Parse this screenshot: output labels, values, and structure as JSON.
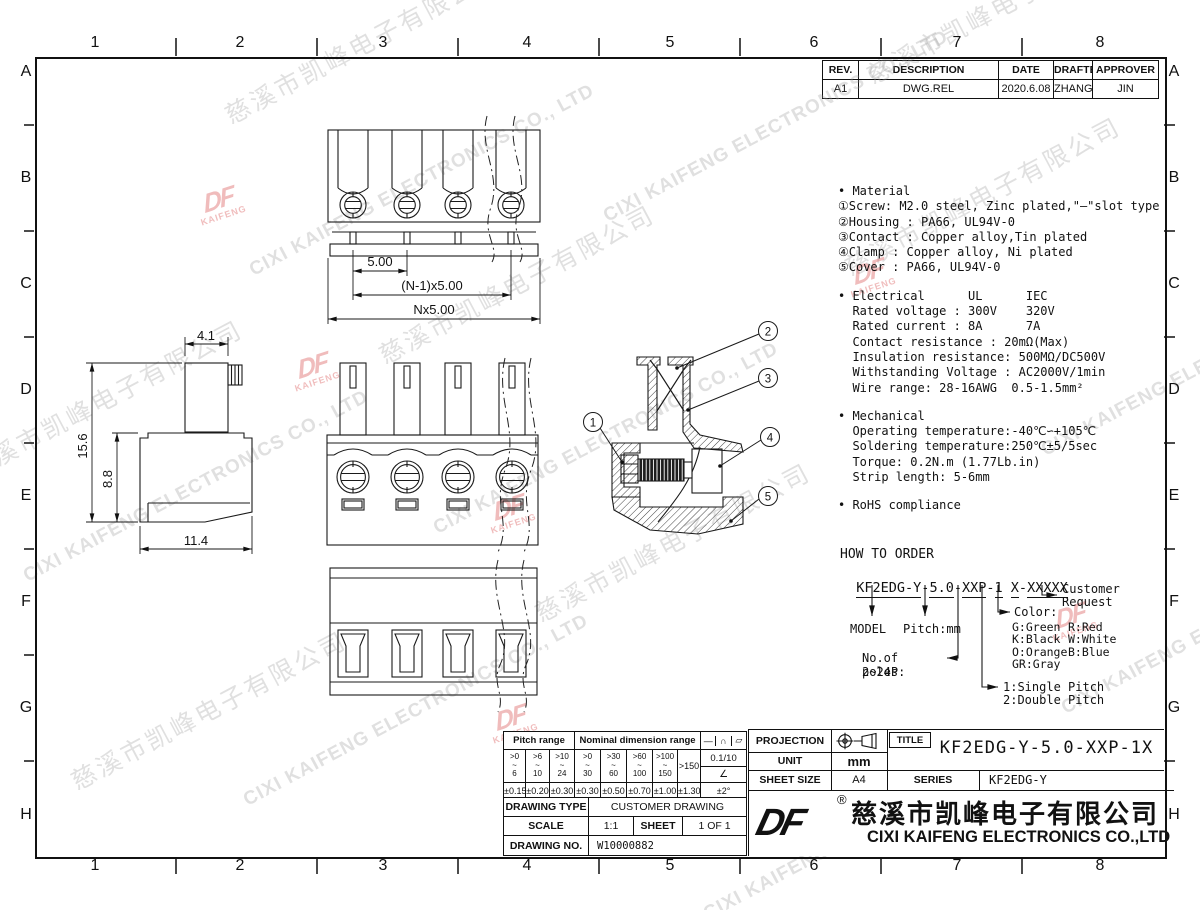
{
  "watermark": {
    "zh": "慈溪市凯峰电子有限公司",
    "en": "CIXI KAIFENG ELECTRONICS CO., LTD",
    "df": "DF",
    "kaifeng": "KAIFENG"
  },
  "grid": {
    "cols": [
      "1",
      "2",
      "3",
      "4",
      "5",
      "6",
      "7",
      "8"
    ],
    "rows": [
      "A",
      "B",
      "C",
      "D",
      "E",
      "F",
      "G",
      "H"
    ]
  },
  "revision": {
    "headers": [
      "REV.",
      "DESCRIPTION",
      "DATE",
      "DRAFTER",
      "APPROVER"
    ],
    "row": [
      "A1",
      "DWG.REL",
      "2020.6.08",
      "ZHANG",
      "JIN"
    ]
  },
  "specs": {
    "material": [
      "• Material",
      "①Screw: M2.0 steel, Zinc plated,\"—\"slot type",
      "②Housing : PA66, UL94V-0",
      "③Contact : Copper alloy,Tin plated",
      "④Clamp : Copper alloy, Ni plated",
      "⑤Cover : PA66, UL94V-0"
    ],
    "electrical": [
      "• Electrical      UL      IEC",
      "  Rated voltage : 300V    320V",
      "  Rated current : 8A      7A",
      "  Contact resistance : 20mΩ(Max)",
      "  Insulation resistance: 500MΩ/DC500V",
      "  Withstanding Voltage : AC2000V/1min",
      "  Wire range: 28-16AWG  0.5-1.5mm²"
    ],
    "mechanical": [
      "• Mechanical",
      "  Operating temperature:-40℃∽+105℃",
      "  Soldering temperature:250℃±5/5sec",
      "  Torque: 0.2N.m (1.77Lb.in)",
      "  Strip length: 5-6mm"
    ],
    "rohs": "• RoHS compliance"
  },
  "order": {
    "title": "HOW TO ORDER",
    "seg": [
      "KF2EDG-Y",
      "5.0",
      "XXP",
      "1",
      "X",
      "XXXXX"
    ],
    "dash": "-",
    "space": " ",
    "model": "MODEL",
    "pitch": "Pitch:mm",
    "poles_label": "No.of poles:",
    "poles_range": "2~24P",
    "pitch1": "1:Single Pitch",
    "pitch2": "2:Double Pitch",
    "color_title": "Color:",
    "colors_left": [
      "G:Green",
      "K:Black",
      "O:Orange",
      "GR:Gray"
    ],
    "colors_right": [
      "R:Red",
      "W:White",
      "B:Blue",
      ""
    ],
    "customer1": "Customer",
    "customer2": "Request"
  },
  "dims": {
    "pitch": "5.00",
    "pitch_n1": "(N-1)x5.00",
    "pitch_n": "Nx5.00",
    "w_top": "4.1",
    "h_total": "15.6",
    "h_body": "8.8",
    "w_bottom": "11.4"
  },
  "callouts": [
    "1",
    "2",
    "3",
    "4",
    "5"
  ],
  "tol": {
    "pitch_header": "Pitch range",
    "nominal_header": "Nominal dimension range",
    "symbols": [
      "—",
      "∩",
      "▱"
    ],
    "ranges": [
      [
        ">0",
        "~",
        "6"
      ],
      [
        ">6",
        "~",
        "10"
      ],
      [
        ">10",
        "~",
        "24"
      ],
      [
        ">0",
        "~",
        "30"
      ],
      [
        ">30",
        "~",
        "60"
      ],
      [
        ">60",
        "~",
        "100"
      ],
      [
        ">100",
        "~",
        "150"
      ]
    ],
    "range_max": ">150",
    "ratio": "0.1/10",
    "angle_symbol": "∠",
    "values": [
      "±0.15",
      "±0.20",
      "±0.30",
      "±0.30",
      "±0.50",
      "±0.70",
      "±1.00",
      "±1.30"
    ],
    "angle_value": "±2°"
  },
  "titleblock": {
    "projection": "PROJECTION",
    "unit": "UNIT",
    "unit_value": "mm",
    "sheet_size": "SHEET SIZE",
    "sheet_size_value": "A4",
    "title_label": "TITLE",
    "title_value": "KF2EDG-Y-5.0-XXP-1X",
    "series_label": "SERIES",
    "series_value": "KF2EDG-Y",
    "drawing_type": "DRAWING TYPE",
    "drawing_type_value": "CUSTOMER DRAWING",
    "scale": "SCALE",
    "scale_value": "1:1",
    "sheet": "SHEET",
    "sheet_value": "1 OF 1",
    "drawing_no": "DRAWING NO.",
    "drawing_no_value": "W10000882",
    "company_zh": "慈溪市凯峰电子有限公司",
    "company_en": "CIXI KAIFENG ELECTRONICS CO.,LTD",
    "registered": "®",
    "logo": "DF"
  }
}
